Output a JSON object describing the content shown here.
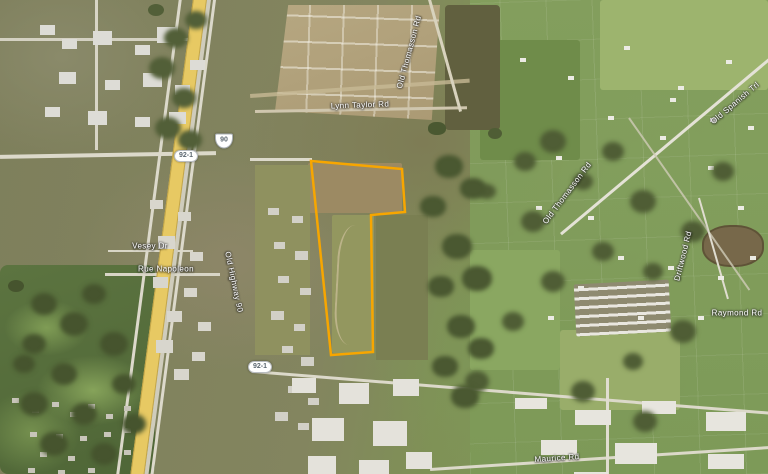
{
  "map": {
    "type": "satellite-aerial-imagery",
    "highlight_color": "#F7A600",
    "labels": [
      {
        "text": "Lynn Taylor Rd",
        "x": 360,
        "y": 105,
        "rot": -2
      },
      {
        "text": "Old Thomasson Rd",
        "x": 409,
        "y": 52,
        "rot": -75
      },
      {
        "text": "Old Thomasson Rd",
        "x": 567,
        "y": 193,
        "rot": -53
      },
      {
        "text": "Old Spanish Trl",
        "x": 735,
        "y": 103,
        "rot": -40
      },
      {
        "text": "Driftwood Rd",
        "x": 683,
        "y": 256,
        "rot": -76
      },
      {
        "text": "Raymond Rd",
        "x": 737,
        "y": 313,
        "rot": 0
      },
      {
        "text": "Maurice Rd",
        "x": 557,
        "y": 458,
        "rot": -4
      },
      {
        "text": "Vesey Dr",
        "x": 150,
        "y": 246,
        "rot": 0
      },
      {
        "text": "Rue Napoleon",
        "x": 166,
        "y": 269,
        "rot": 0
      },
      {
        "text": "Old Highway 90",
        "x": 234,
        "y": 282,
        "rot": 78
      }
    ],
    "shields": [
      {
        "text": "90",
        "type": "us",
        "x": 224,
        "y": 141
      },
      {
        "text": "92-1",
        "type": "oval",
        "x": 186,
        "y": 156
      },
      {
        "text": "92-1",
        "type": "oval",
        "x": 260,
        "y": 367
      }
    ],
    "parcel": {
      "points": "311,161 402,169 405,212 371,215 373,352 331,355",
      "stroke_color": "#F7A600",
      "stroke_width": 2.5
    }
  }
}
